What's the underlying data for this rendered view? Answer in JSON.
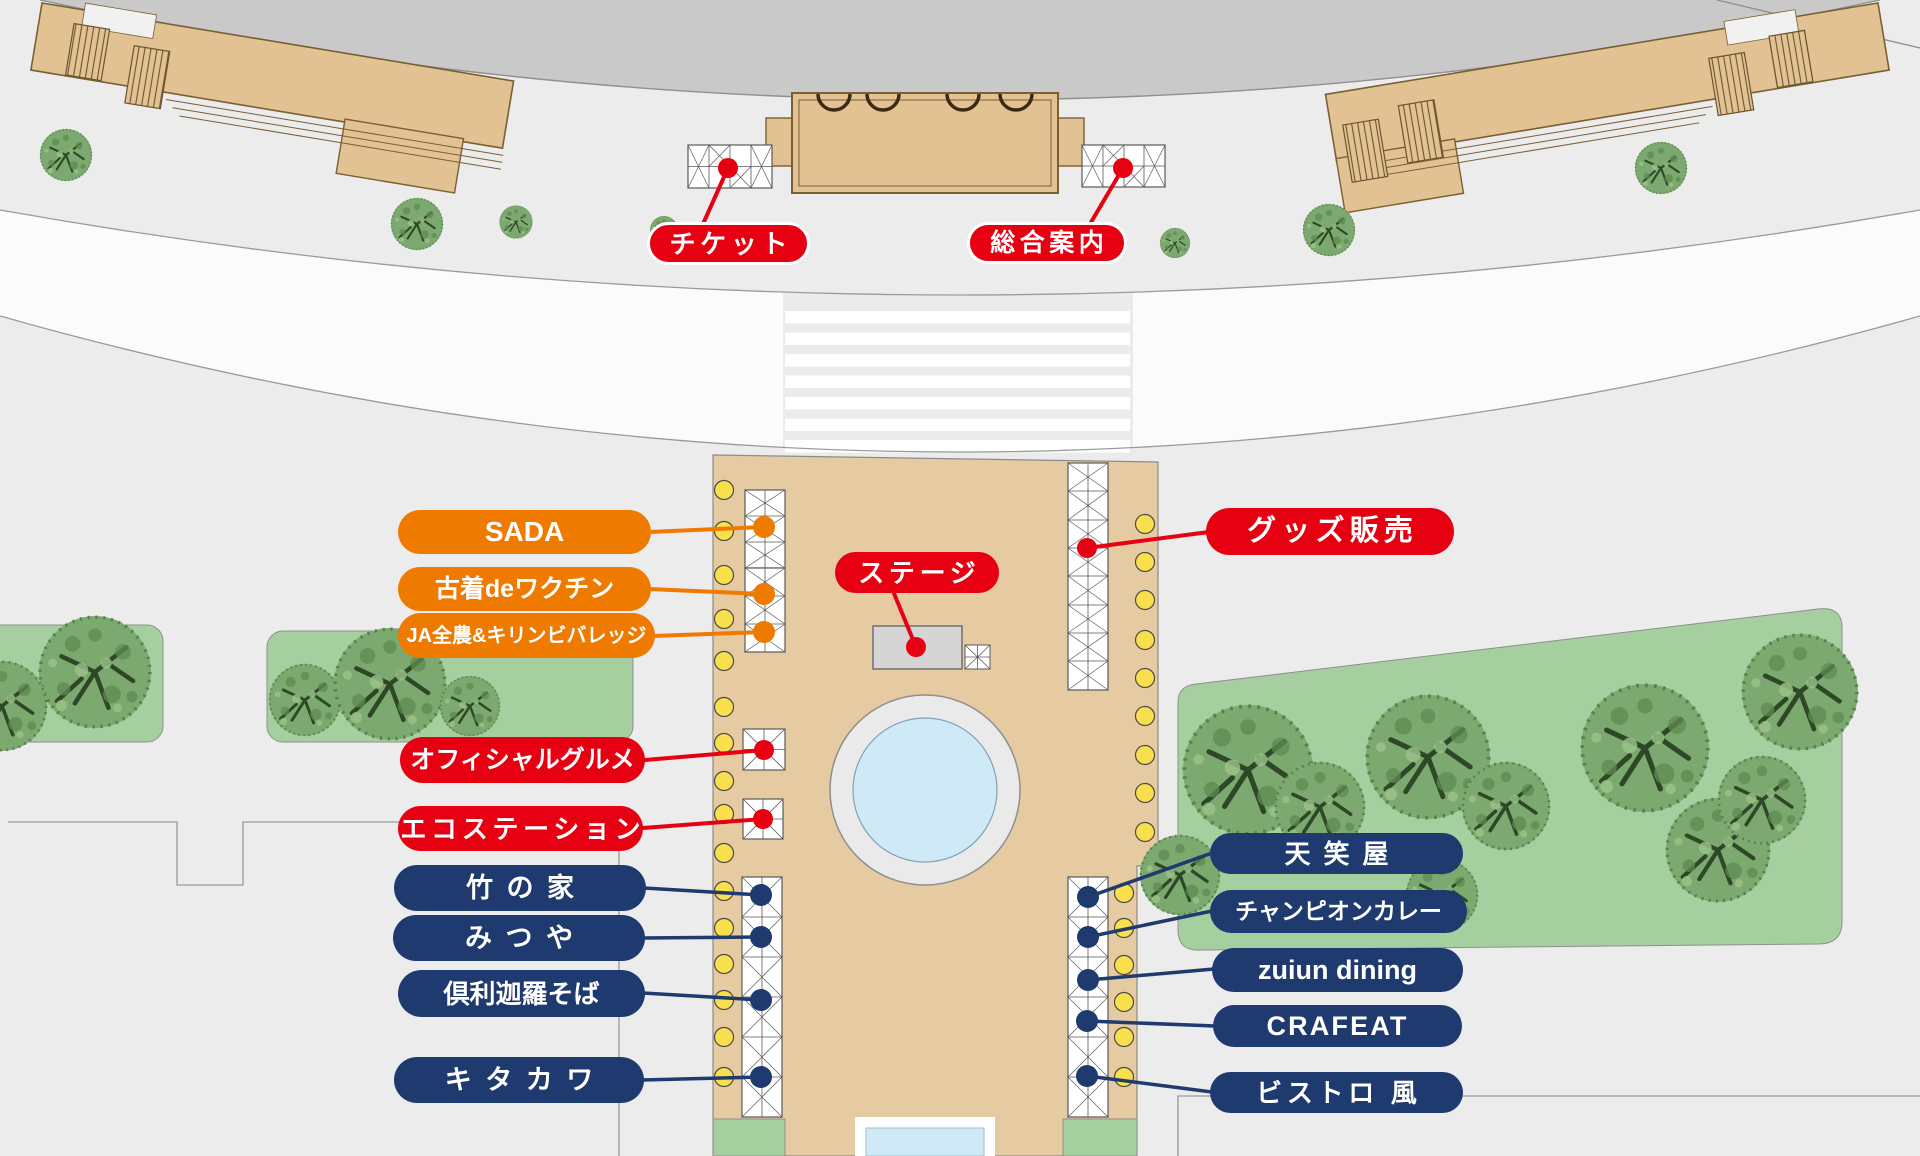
{
  "pills": {
    "ticket": {
      "label": "チケット",
      "type": "service"
    },
    "info": {
      "label": "総合案内",
      "type": "service"
    },
    "stage": {
      "label": "ステージ",
      "type": "service"
    },
    "goods": {
      "label": "グッズ販売",
      "type": "service"
    },
    "sada": {
      "label": "SADA",
      "type": "sponsor"
    },
    "furugi": {
      "label": "古着deワクチン",
      "type": "sponsor"
    },
    "ja": {
      "label": "JA全農&キリンビバレッジ",
      "type": "sponsor"
    },
    "gourmet": {
      "label": "オフィシャルグルメ",
      "type": "service"
    },
    "eco": {
      "label": "エコステーション",
      "type": "service"
    },
    "takenoya": {
      "label": "竹の家",
      "type": "food"
    },
    "mitsuya": {
      "label": "みつや",
      "type": "food"
    },
    "kurikara": {
      "label": "倶利迦羅そば",
      "type": "food"
    },
    "kitakawa": {
      "label": "キタカワ",
      "type": "food"
    },
    "tenshoya": {
      "label": "天笑屋",
      "type": "food"
    },
    "championcurry": {
      "label": "チャンピオンカレー",
      "type": "food"
    },
    "zuiun": {
      "label": "zuiun dining",
      "type": "food"
    },
    "crafeat": {
      "label": "CRAFEAT",
      "type": "food"
    },
    "bistro": {
      "label": "ビストロ 風",
      "type": "food"
    }
  },
  "colors": {
    "bg": "#ececec",
    "band": "#c9c9c9",
    "road": "#fbfbfb",
    "building": "#e2c193",
    "building_stroke": "#7a5f33",
    "plaza": "#e5caa2",
    "green": "#a6cf9f",
    "tree": "#7ca96f",
    "water": "#cfe9f7",
    "yellow": "#f8df4b",
    "stage_gray": "#d5d5d5",
    "red": "#e60012",
    "orange": "#ee7a00",
    "navy": "#1e3a6e"
  }
}
